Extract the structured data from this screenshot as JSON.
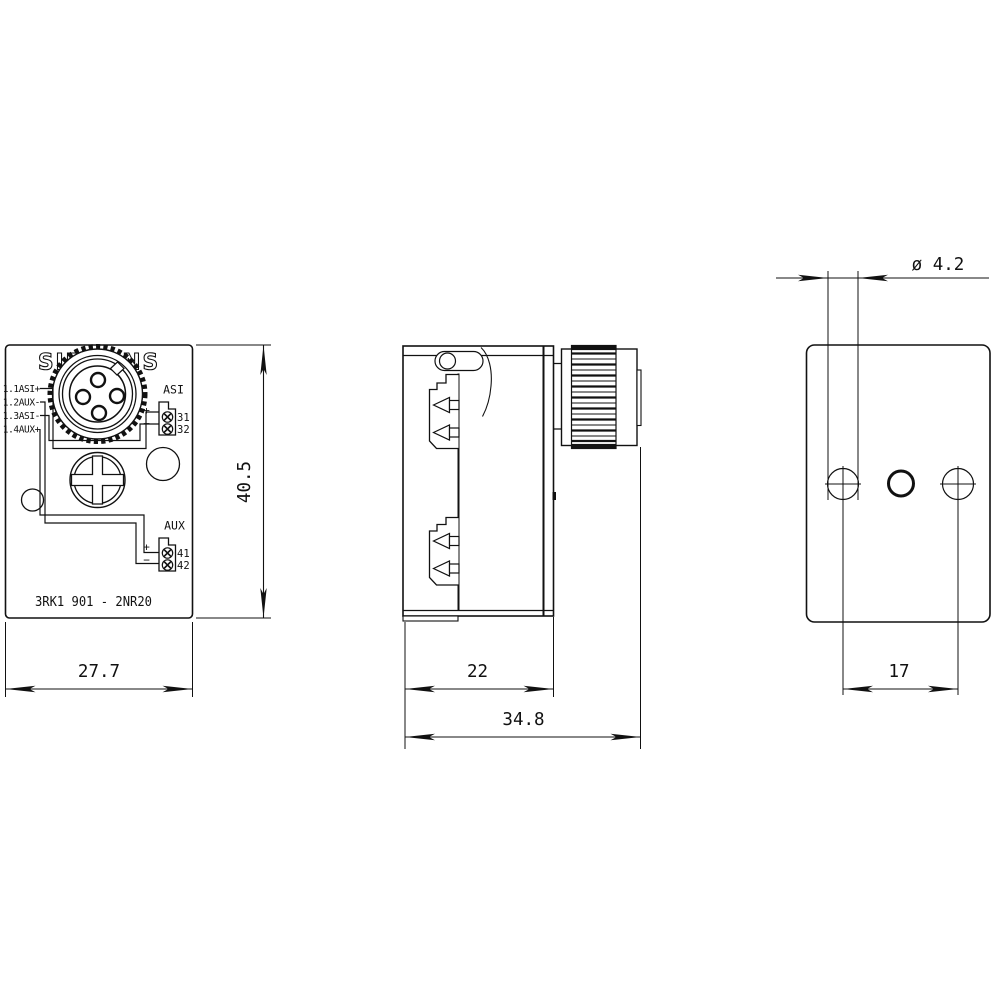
{
  "drawing": {
    "brand": "SIEMENS",
    "part_number": "3RK1 901 - 2NR20",
    "front": {
      "pin_labels": [
        "1.1ASI+",
        "1.2AUX-",
        "1.3ASI-",
        "1.4AUX+"
      ],
      "asi_group": {
        "label": "ASI",
        "plus": "+",
        "minus": "−",
        "terminal_top": "31",
        "terminal_bottom": "32"
      },
      "aux_group": {
        "label": "AUX",
        "plus": "+",
        "minus": "−",
        "terminal_top": "41",
        "terminal_bottom": "42"
      },
      "width_dim": "27.7",
      "height_dim": "40.5"
    },
    "side": {
      "body_depth_dim": "22",
      "total_depth_dim": "34.8"
    },
    "back": {
      "hole_diameter_dim": "ø 4.2",
      "hole_spacing_dim": "17"
    },
    "colors": {
      "line": "#111111",
      "background": "#ffffff"
    }
  }
}
